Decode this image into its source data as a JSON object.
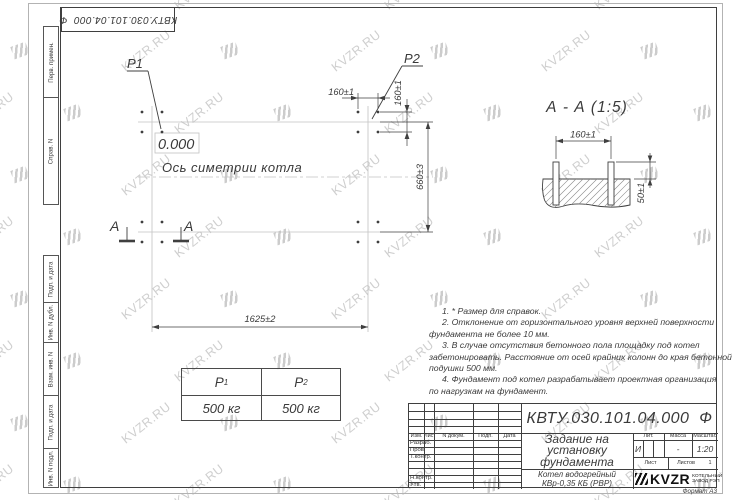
{
  "sheet": {
    "format_label": "Формат А3"
  },
  "stamp": {
    "designation": "КВТУ.030.101.04.000  Ф"
  },
  "margin_columns": {
    "top": [
      "Перв. примен.",
      "Справ. N"
    ],
    "bottom": [
      "Подп. и дата",
      "Инв. N дубл.",
      "Взам. инв. N",
      "Подп. и дата",
      "Инв. N подл."
    ]
  },
  "plan": {
    "load_point_1": "P1",
    "load_point_2": "P2",
    "level_mark": "0.000",
    "axis_label": "Ось симетрии котла",
    "dim_bolt_pitch_x": "160±1",
    "dim_bolt_pitch_y": "160±1",
    "dim_length": "1625±2",
    "dim_width": "660±3",
    "section_letter_left": "A",
    "section_letter_right": "A"
  },
  "section_view": {
    "title": "А - А (1:5)",
    "dim_bolt_pitch": "160±1",
    "dim_bolt_height": "50±1"
  },
  "load_table": {
    "headers": [
      {
        "sym": "P",
        "sub": "1"
      },
      {
        "sym": "P",
        "sub": "2"
      }
    ],
    "values": [
      "500 кг",
      "500 кг"
    ]
  },
  "notes": {
    "lines": [
      "1. * Размер для справок.",
      "2. Отклонение от горизонтального уровня верхней поверхности",
      "фундамента не более 10 мм.",
      "3. В случае отсутствия бетонного пола площадку под котел",
      "забетонировать. Расстояние от осей крайних колонн до края бетонной",
      "подушки 500 мм.",
      "4. Фундамент под котел разрабатывает проектная организация",
      "по нагрузкам на фундамент."
    ]
  },
  "title_block": {
    "designation": "КВТУ.030.101.04.000  Ф",
    "title_lines": [
      "Задание на",
      "установку",
      "фундамента"
    ],
    "product_lines": [
      "Котел водогрейный",
      "КВр-0,35 КБ (РВР)"
    ],
    "columns": [
      "Изм.",
      "Лист",
      "N докум.",
      "Подп.",
      "Дата"
    ],
    "signature_rows": [
      "Разраб.",
      "Пров.",
      "Т.контр.",
      "Н.контр.",
      "Утв."
    ],
    "lit_label": "Лит.",
    "lit_value": "И",
    "mass_label": "Масса",
    "mass_value": "-",
    "scale_label": "Масштаб",
    "scale_value": "1:20",
    "sheet_label": "Лист",
    "sheets_label": "Листов",
    "sheets_count": "1",
    "logo_text": "KVZR",
    "company_lines": [
      "КОТЕЛЬНЫЙ",
      "ЗАВОД РЭП"
    ]
  },
  "watermark": {
    "text": "KVZR.RU"
  },
  "colors": {
    "line": "#3f3f3f",
    "light_line": "#c2c2c2",
    "watermark": "#cfcfcf"
  }
}
